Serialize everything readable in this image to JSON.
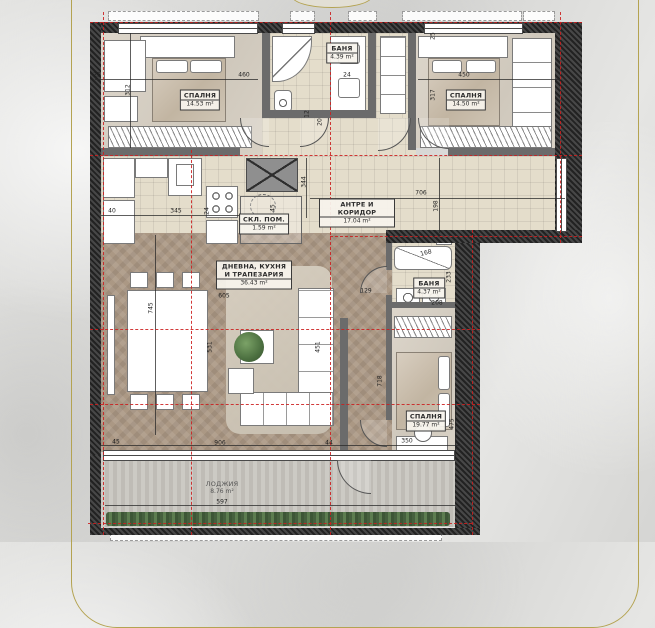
{
  "document": {
    "kind": "apartment-floor-plan",
    "language": "Bulgarian"
  },
  "colors": {
    "frame_gold": "#b4a351",
    "axis_red": "#cc1f1f",
    "wall_dark": "#2f2f2f",
    "wood_floor": "#ab9884",
    "tile_floor": "#e4ddcb",
    "marble_floor": "#d6cfc4",
    "loggia_floor": "#c6c3bd",
    "planter_green": "#4e6f45"
  },
  "plan": {
    "rooms": [
      {
        "id": "bedroom-1",
        "name": "СПАЛНЯ",
        "area": "14.53 m²",
        "label": {
          "x": 200,
          "y": 100
        }
      },
      {
        "id": "bathroom-1",
        "name": "БАНЯ",
        "area": "4.39 m²",
        "label": {
          "x": 342,
          "y": 53
        }
      },
      {
        "id": "bedroom-2",
        "name": "СПАЛНЯ",
        "area": "14.50 m²",
        "label": {
          "x": 466,
          "y": 100
        }
      },
      {
        "id": "hallway",
        "name": "АНТРЕ И КОРИДОР",
        "area": "17.04 m²",
        "label": {
          "x": 357,
          "y": 213
        }
      },
      {
        "id": "storage",
        "name": "СКЛ. ПОМ.",
        "area": "1.59 m²",
        "label": {
          "x": 264,
          "y": 224
        }
      },
      {
        "id": "bathroom-2",
        "name": "БАНЯ",
        "area": "4.37 m²",
        "label": {
          "x": 429,
          "y": 288
        }
      },
      {
        "id": "living-kitchen-dining",
        "name": "ДНЕВНА, КУХНЯ И ТРАПЕЗАРИЯ",
        "area": "36.43 m²",
        "label": {
          "x": 254,
          "y": 275
        }
      },
      {
        "id": "bedroom-3",
        "name": "СПАЛНЯ",
        "area": "19.77 m²",
        "label": {
          "x": 426,
          "y": 421
        }
      },
      {
        "id": "loggia",
        "name": "ЛОДЖИЯ",
        "area": "8.76 m²",
        "label": {
          "x": 222,
          "y": 488
        },
        "unboxed": true
      }
    ],
    "dimensions": [
      {
        "value": "25",
        "x": 97,
        "y": 75
      },
      {
        "value": "312",
        "x": 128,
        "y": 90,
        "rot": -90
      },
      {
        "value": "460",
        "x": 244,
        "y": 75
      },
      {
        "value": "24",
        "x": 347,
        "y": 75
      },
      {
        "value": "450",
        "x": 464,
        "y": 75
      },
      {
        "value": "25",
        "x": 433,
        "y": 36,
        "rot": -90
      },
      {
        "value": "317",
        "x": 433,
        "y": 95,
        "rot": -90
      },
      {
        "value": "12",
        "x": 307,
        "y": 114,
        "rot": -90
      },
      {
        "value": "20",
        "x": 320,
        "y": 122,
        "rot": -90
      },
      {
        "value": "344",
        "x": 304,
        "y": 182,
        "rot": -90
      },
      {
        "value": "706",
        "x": 421,
        "y": 193
      },
      {
        "value": "198",
        "x": 436,
        "y": 206,
        "rot": -90
      },
      {
        "value": "40",
        "x": 112,
        "y": 211
      },
      {
        "value": "345",
        "x": 176,
        "y": 211
      },
      {
        "value": "24",
        "x": 207,
        "y": 211,
        "rot": -90
      },
      {
        "value": "45",
        "x": 273,
        "y": 208,
        "rot": -90
      },
      {
        "value": "745",
        "x": 151,
        "y": 308,
        "rot": -90
      },
      {
        "value": "605",
        "x": 224,
        "y": 296
      },
      {
        "value": "531",
        "x": 210,
        "y": 347,
        "rot": -90
      },
      {
        "value": "451",
        "x": 318,
        "y": 347,
        "rot": -90
      },
      {
        "value": "129",
        "x": 366,
        "y": 291
      },
      {
        "value": "718",
        "x": 380,
        "y": 381,
        "rot": -90
      },
      {
        "value": "168",
        "x": 426,
        "y": 253,
        "rot": -14
      },
      {
        "value": "233",
        "x": 449,
        "y": 277,
        "rot": -90
      },
      {
        "value": "208",
        "x": 437,
        "y": 303
      },
      {
        "value": "350",
        "x": 407,
        "y": 441
      },
      {
        "value": "475",
        "x": 452,
        "y": 424,
        "rot": -90
      },
      {
        "value": "45",
        "x": 116,
        "y": 442
      },
      {
        "value": "906",
        "x": 220,
        "y": 443
      },
      {
        "value": "44",
        "x": 329,
        "y": 443
      },
      {
        "value": "597",
        "x": 222,
        "y": 502
      }
    ]
  }
}
